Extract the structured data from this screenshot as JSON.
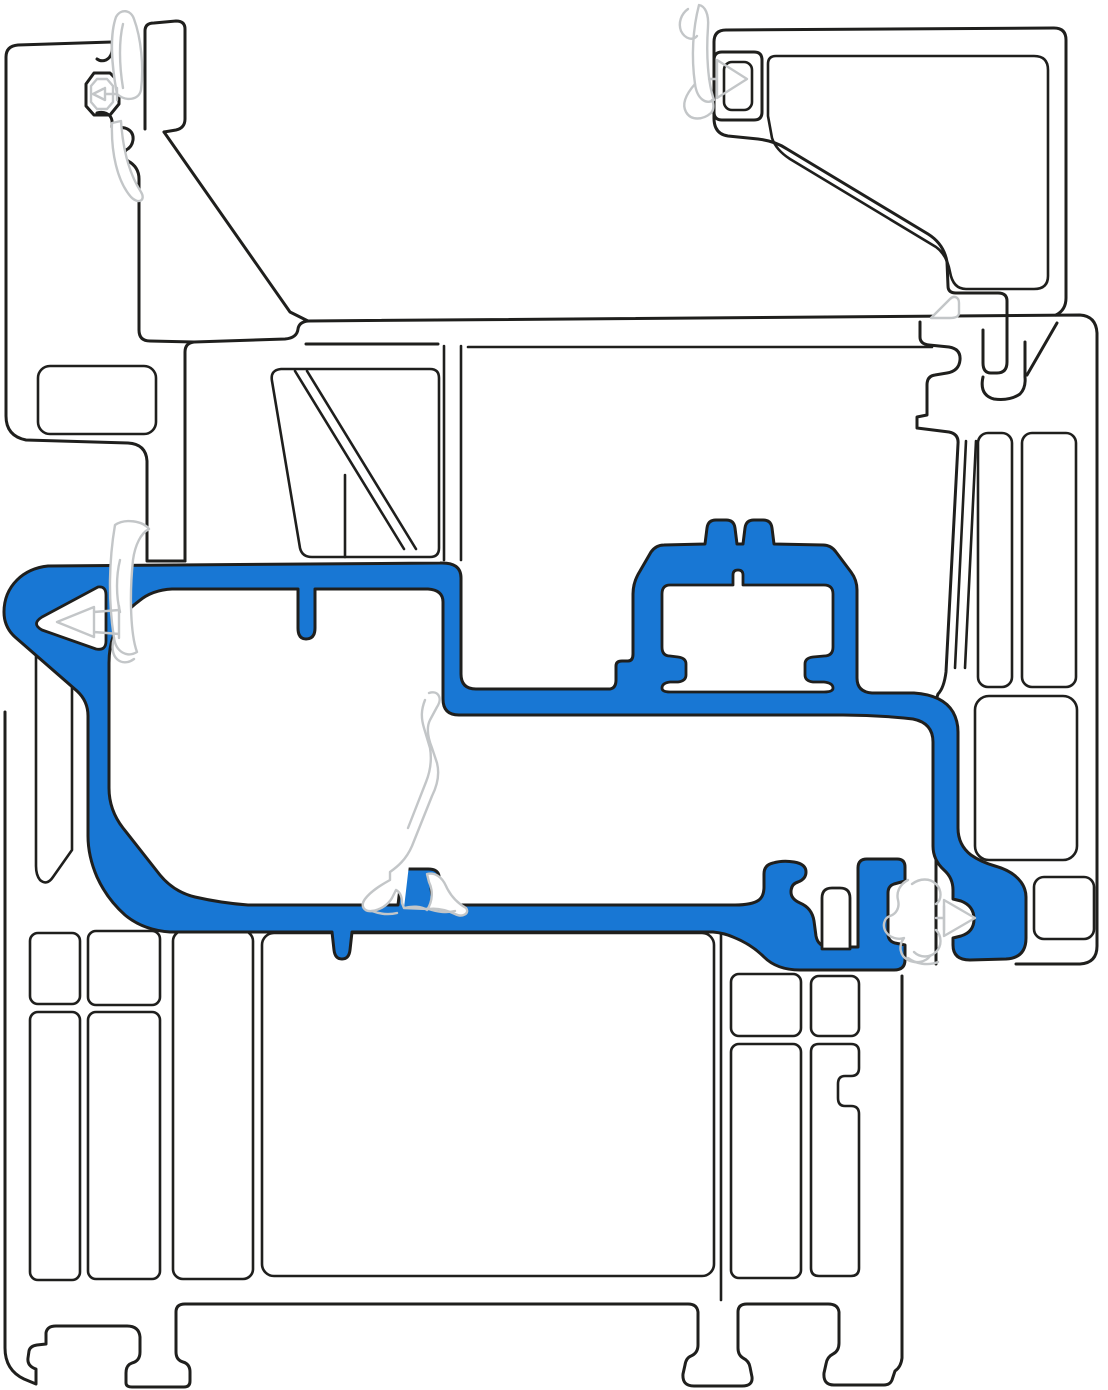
{
  "diagram": {
    "type": "technical-cross-section",
    "subject": "uPVC window / door profile corner section",
    "orientation": "frame corner with sash and coupling profile",
    "text_content": "none"
  },
  "colors": {
    "background": "#ffffff",
    "profile_fill": "#ffffff",
    "outline": "#1f1f1d",
    "highlight": "#1877d4",
    "gasket": "#c3c6c8"
  },
  "parts": [
    {
      "id": "outer-frame-left",
      "role": "white profile, top-left jamb with gasket pocket and chamber"
    },
    {
      "id": "transom-band",
      "role": "white profile, horizontal band with trapezoid chamber and diagonal struts"
    },
    {
      "id": "sash-top-right",
      "role": "white profile, Z-shaped sash with glazing pocket and interlock hook"
    },
    {
      "id": "frame-right",
      "role": "white profile, right frame with tall chambers and bottom rounded corner"
    },
    {
      "id": "sill-bottom",
      "role": "white profile, bottom sill with multiple chambers and mounting feet"
    },
    {
      "id": "mullion-bottom-right",
      "role": "white profile, vertical mullion with notched chamber"
    },
    {
      "id": "highlight-profile",
      "role": "blue highlighted coupling / threshold adapter profile with glazing hat"
    },
    {
      "id": "gaskets",
      "role": "light gray rubber seals: top-left flag, left arrow seal, top-right flag with arrow, center standing seal, right interlock seal, small wedge seal"
    }
  ]
}
